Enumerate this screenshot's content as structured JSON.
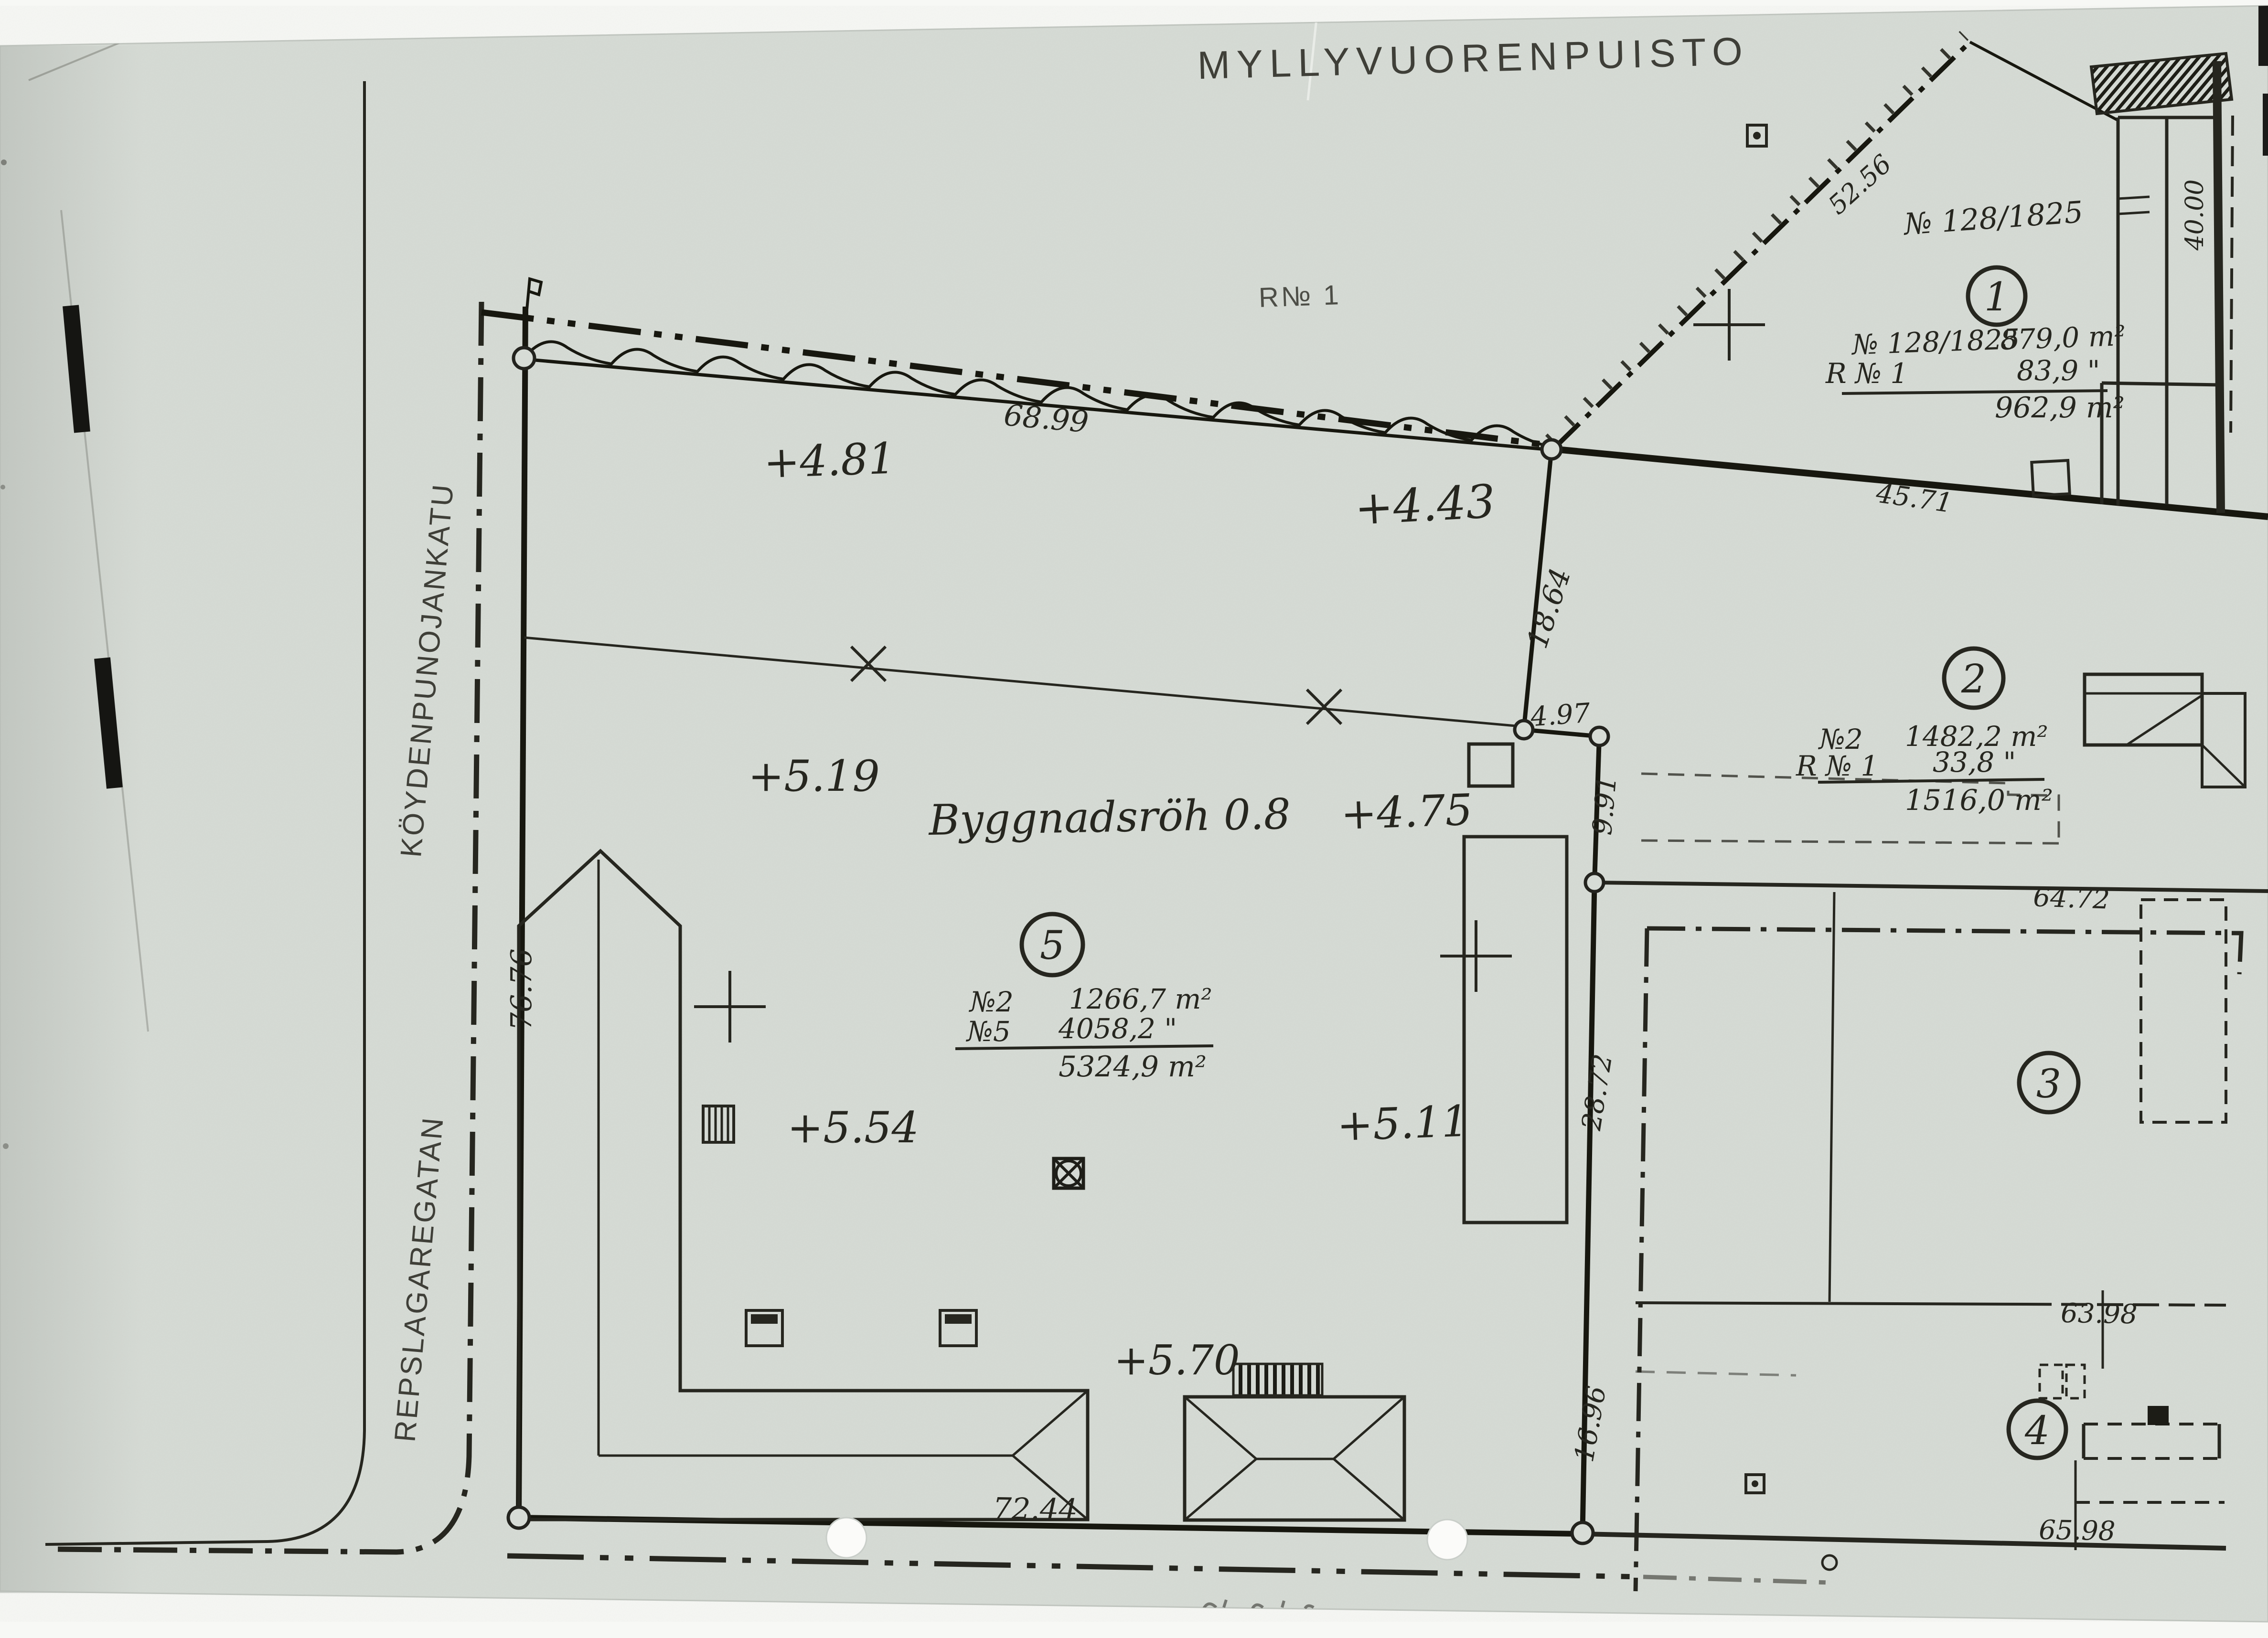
{
  "map": {
    "park_label": "MYLLYVUORENPUISTO",
    "area_label": "R№ 1",
    "plot_id_note": "№ 128/1825",
    "building_height_note": "Byggnadsröh 0.8"
  },
  "streets": [
    {
      "name": "KÖYDENPUNOJANKATU"
    },
    {
      "name": "REPSLAGAREGATAN"
    }
  ],
  "parcels": {
    "p1": {
      "badge": "1",
      "row1_label": "№ 128/1825",
      "row1_value": "879,0 m²",
      "row2_label": "R № 1",
      "row2_value": "83,9 \"",
      "total": "962,9 m²"
    },
    "p2": {
      "badge": "2",
      "row1_label": "№2",
      "row1_value": "1482,2 m²",
      "row2_label": "R № 1",
      "row2_value": "33,8 \"",
      "total": "1516,0 m²"
    },
    "p3": {
      "badge": "3"
    },
    "p4": {
      "badge": "4"
    },
    "p5": {
      "badge": "5",
      "row1_label": "№2",
      "row1_value": "1266,7 m²",
      "row2_label": "№5",
      "row2_value": "4058,2 \"",
      "total": "5324,9 m²"
    }
  },
  "measurements": {
    "north": "68.99",
    "ne_vert": "18.64",
    "ne_jog": "4.97",
    "ne_drop": "9.91",
    "east_upper": "28.72",
    "east_lower": "16.96",
    "south": "72.44",
    "west": "76.76",
    "right_top": "64.72",
    "right_mid": "63.98",
    "right_bottom": "65.98",
    "diag_upper": "52.56",
    "diag_lower": "45.71",
    "wall": "40.00"
  },
  "elevations": {
    "e1": "+4.81",
    "e2": "+4.43",
    "e3": "+5.19",
    "e4": "+4.75",
    "e5": "+5.54",
    "e6": "+5.11",
    "e7": "+5.70"
  }
}
